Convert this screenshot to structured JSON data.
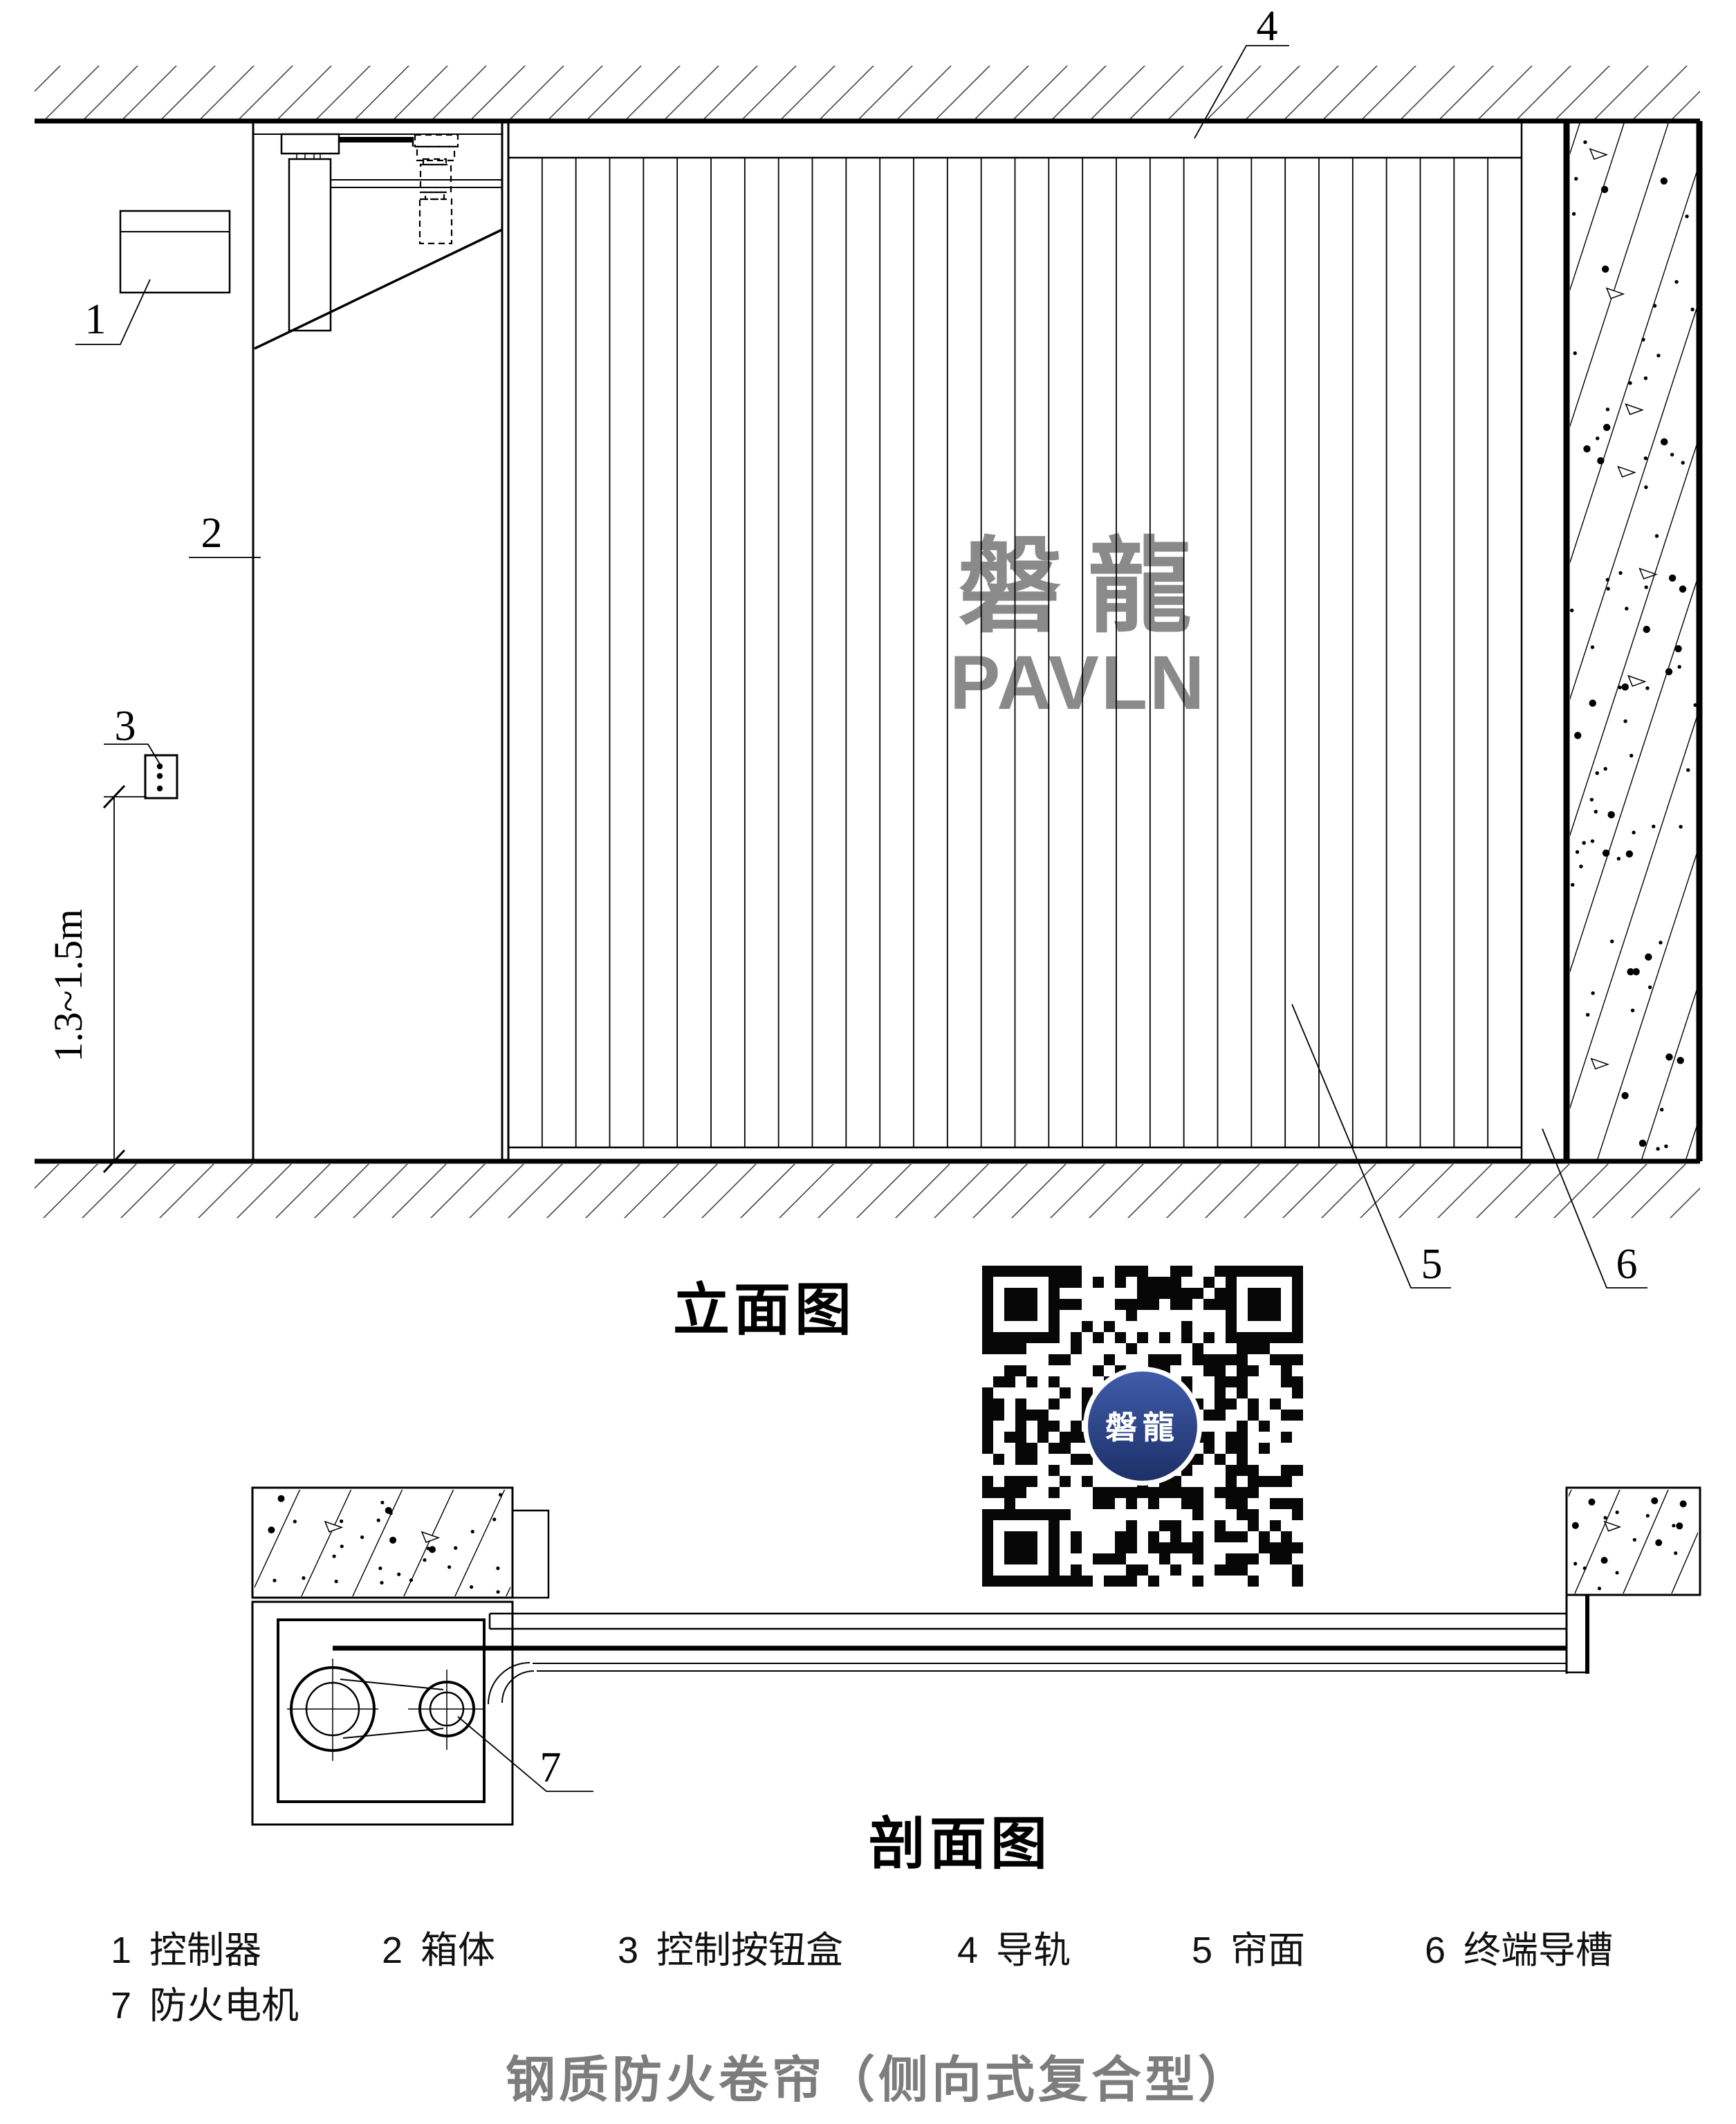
{
  "drawing": {
    "title": "钢质防火卷帘（侧向式复合型）",
    "elevation_label": "立面图",
    "section_label": "剖面图",
    "dimension_label": "1.3~1.5m"
  },
  "watermark": {
    "cjk": "磐龍",
    "latin": "PAVLN",
    "color": "#8a8a8a"
  },
  "callouts": {
    "c1": "1",
    "c2": "2",
    "c3": "3",
    "c4": "4",
    "c5": "5",
    "c6": "6",
    "c7": "7"
  },
  "legend": {
    "row1": [
      {
        "num": "1",
        "label": "控制器"
      },
      {
        "num": "2",
        "label": "箱体"
      },
      {
        "num": "3",
        "label": "控制按钮盒"
      },
      {
        "num": "4",
        "label": "导轨"
      },
      {
        "num": "5",
        "label": "帘面"
      },
      {
        "num": "6",
        "label": "终端导槽"
      }
    ],
    "row2": [
      {
        "num": "7",
        "label": "防火电机"
      }
    ]
  },
  "qr": {
    "logo_text": "磐龍",
    "logo_color_top": "#3f5caa",
    "logo_color_bottom": "#1d3068"
  },
  "colors": {
    "line": "#000000",
    "title_gray": "#7d7d7d",
    "hatch": "#444444"
  }
}
